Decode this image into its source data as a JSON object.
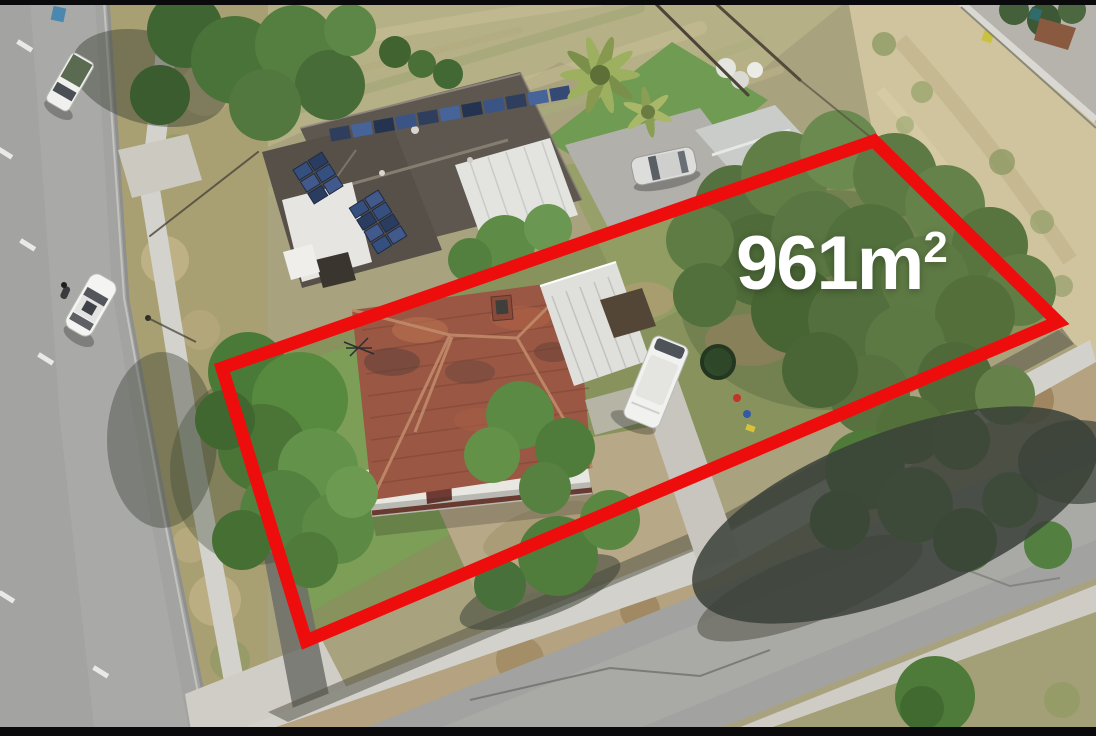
{
  "overlay": {
    "area_text": "961m",
    "area_superscript": "2",
    "boundary_points": "222,368 874,141 1058,322 306,641",
    "boundary_color": "#ee0d0d",
    "label_color": "#ffffff"
  },
  "frame": {
    "letterbox_color": "#0a0a0c"
  },
  "scene": {
    "type": "aerial-drone-photo-of-residential-lot",
    "features": [
      "left-street",
      "bottom-street",
      "subject-house-tiled-roof",
      "carport",
      "neighbour-house-with-solar-panels",
      "garage",
      "dry-paddock",
      "sandy-lot",
      "tree-canopy",
      "footpaths"
    ],
    "vehicles": [
      "white-ute",
      "white-parked-car",
      "cyclist",
      "silver-sedan",
      "white-campervan"
    ]
  }
}
